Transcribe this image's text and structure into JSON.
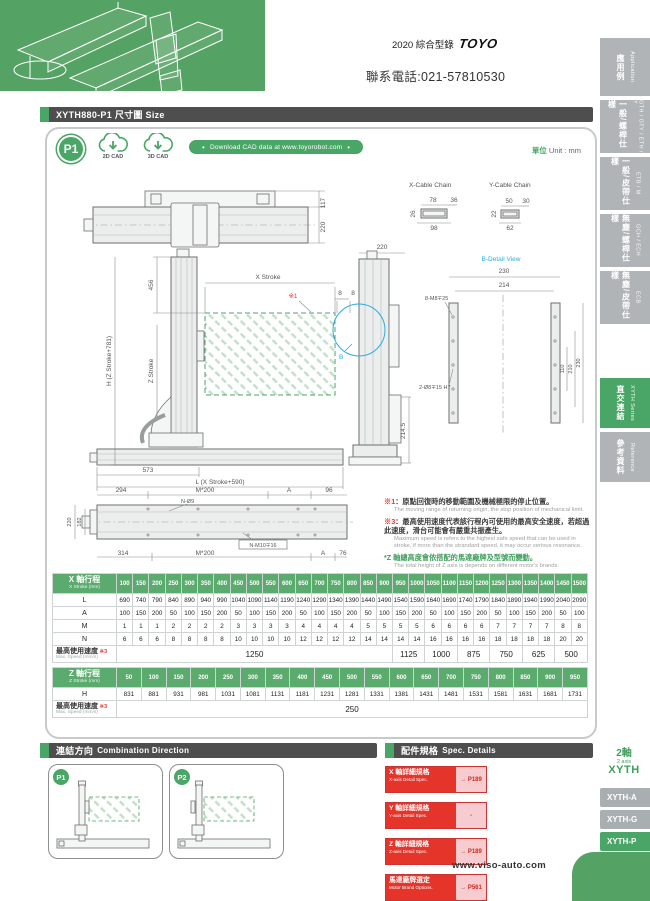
{
  "header": {
    "catalog": "2020 綜合型錄",
    "brand": "TOYO",
    "phone": "聯系電話:021-57810530"
  },
  "title_bar": "XYTH880-P1 尺寸圖 Size",
  "panel": {
    "badge": "P1",
    "cad2d": "2D CAD",
    "cad3d": "3D CAD",
    "download": "Download CAD data at www.toyorobot.com",
    "unit_zh": "單位",
    "unit_en": "Unit : mm"
  },
  "drawings": {
    "top_view": {
      "dim_117": "117",
      "dim_220": "220"
    },
    "cable": {
      "x_title": "X-Cable Chain",
      "x_top": "78",
      "x_right": "36",
      "x_left": "26",
      "x_bottom": "98",
      "y_title": "Y-Cable Chain",
      "y_top": "50",
      "y_right": "30",
      "y_left": "22",
      "y_bottom": "62"
    },
    "front": {
      "dim_456": "456",
      "dim_h": "H (Z Stroke+781)",
      "dim_z": "Z Stroke",
      "dim_x": "X Stroke",
      "ref1": "※1",
      "dim_8a": "8",
      "dim_8b": "8",
      "dim_573": "573",
      "dim_l": "L (X Stroke+590)"
    },
    "side": {
      "dim_220": "220",
      "dim_2145": "214.5",
      "b_label": "B"
    },
    "bdetail": {
      "title": "B-Detail View",
      "dim_230t": "230",
      "dim_214": "214",
      "holes_a": "8-M8∓25",
      "holes_b": "2-Ø8∓15 H7",
      "dim_110": "110",
      "dim_210": "210",
      "dim_230r": "230"
    },
    "bottom": {
      "dim_294": "294",
      "dim_m200t": "M*200",
      "dim_at": "A",
      "dim_96": "96",
      "holes_top": "N-Ø9",
      "dim_220": "220",
      "dim_182": "182",
      "dim_314": "314",
      "dim_m200b": "M*200",
      "holes_bottom": "N-M10∓16",
      "dim_ab": "A",
      "dim_76": "76"
    }
  },
  "notes": {
    "n1_ref": "※1",
    "n1_zh": "：原點回復時的移動範圍及機械極限的停止位置。",
    "n1_en": "The moving range of returning origin, the stop position of mechanical limit.",
    "n3_ref": "※3",
    "n3_zh": "：最高使用速度代表該行程內可使用的最高安全速度，若超過此速度，滑台可能會有嚴重共振產生。",
    "n3_en": "Maximum speed is refers to the highest safe speed that can be used in stroke, if more than the strandard speed, it may occur serious resonance.",
    "nz_zh": "*Z 軸總高度會依搭配的馬達廠牌及型號而變動。",
    "nz_en": "The total height of Z axis is depends on different motor's brands."
  },
  "x_table": {
    "header_zh": "X 軸行程",
    "header_en": "X Stroke (mm)",
    "strokes": [
      100,
      150,
      200,
      250,
      300,
      350,
      400,
      450,
      500,
      550,
      600,
      650,
      700,
      750,
      800,
      850,
      900,
      950,
      1000,
      1050,
      1100,
      1150,
      1200,
      1250,
      1300,
      1350,
      1400,
      1450,
      1500
    ],
    "rows": [
      {
        "label": "L",
        "values": [
          690,
          740,
          790,
          840,
          890,
          940,
          990,
          1040,
          1090,
          1140,
          1190,
          1240,
          1290,
          1340,
          1390,
          1440,
          1490,
          1540,
          1590,
          1640,
          1690,
          1740,
          1790,
          1840,
          1890,
          1940,
          1990,
          2040,
          2090
        ]
      },
      {
        "label": "A",
        "values": [
          100,
          150,
          200,
          50,
          100,
          150,
          200,
          50,
          100,
          150,
          200,
          50,
          100,
          150,
          200,
          50,
          100,
          150,
          200,
          50,
          100,
          150,
          200,
          50,
          100,
          150,
          200,
          50,
          100
        ]
      },
      {
        "label": "M",
        "values": [
          1,
          1,
          1,
          2,
          2,
          2,
          2,
          3,
          3,
          3,
          3,
          4,
          4,
          4,
          4,
          5,
          5,
          5,
          5,
          6,
          6,
          6,
          6,
          7,
          7,
          7,
          7,
          8,
          8
        ]
      },
      {
        "label": "N",
        "values": [
          6,
          6,
          6,
          8,
          8,
          8,
          8,
          10,
          10,
          10,
          10,
          12,
          12,
          12,
          12,
          14,
          14,
          14,
          14,
          16,
          16,
          16,
          16,
          18,
          18,
          18,
          18,
          20,
          20
        ]
      }
    ],
    "speed_label_zh": "最高使用速度",
    "speed_note": "※3",
    "speed_label_en": "Max. Speed (mm/s)",
    "speeds": [
      {
        "value": "1250",
        "span": 17
      },
      {
        "value": "1125",
        "span": 2
      },
      {
        "value": "1000",
        "span": 2
      },
      {
        "value": "875",
        "span": 2
      },
      {
        "value": "750",
        "span": 2
      },
      {
        "value": "625",
        "span": 2
      },
      {
        "value": "500",
        "span": 2
      }
    ]
  },
  "z_table": {
    "header_zh": "Z 軸行程",
    "header_en": "Z Stroke (mm)",
    "strokes": [
      50,
      100,
      150,
      200,
      250,
      300,
      350,
      400,
      450,
      500,
      550,
      600,
      650,
      700,
      750,
      800,
      850,
      900,
      950
    ],
    "rows": [
      {
        "label": "H",
        "values": [
          831,
          881,
          931,
          981,
          1031,
          1081,
          1131,
          1181,
          1231,
          1281,
          1331,
          1381,
          1431,
          1481,
          1531,
          1581,
          1631,
          1681,
          1731
        ]
      }
    ],
    "speed_label_zh": "最高使用速度",
    "speed_note": "※3",
    "speed_label_en": "Max. Speed (mm/s)",
    "speeds": [
      {
        "value": "250",
        "span": 19
      }
    ]
  },
  "combination": {
    "title_zh": "連結方向",
    "title_en": "Combination Direction",
    "items": [
      "P1",
      "P2"
    ]
  },
  "spec_details": {
    "title_zh": "配件規格",
    "title_en": "Spec. Details",
    "buttons": [
      {
        "zh": "X 軸詳細規格",
        "en": "X-axis Detail Spec.",
        "page": "→ P189"
      },
      {
        "zh": "Y 軸詳細規格",
        "en": "Y-axis Detail Spec.",
        "page": "-"
      },
      {
        "zh": "Z 軸詳細規格",
        "en": "Z-axis Detail Spec.",
        "page": "→ P189"
      },
      {
        "zh": "馬達廠牌選定",
        "en": "Motor Brand Options.",
        "page": "→ P561"
      }
    ]
  },
  "series_nav": {
    "axis_zh": "2軸",
    "axis_en": "2 axis",
    "family": "XYTH",
    "tabs": [
      {
        "label": "XYTH-A",
        "active": false
      },
      {
        "label": "XYTH-G",
        "active": false
      },
      {
        "label": "XYTH-P",
        "active": true
      },
      {
        "label": "XYTH-F",
        "active": false
      }
    ]
  },
  "sidebar": {
    "tabs": [
      {
        "zh": "應用例",
        "en": "Application",
        "active": false
      },
      {
        "zh": "一般/螺桿仕樣",
        "en": "GTH / GTY / ETH / Y",
        "active": false
      },
      {
        "zh": "一般/皮帶仕樣",
        "en": "ETB / M",
        "active": false
      },
      {
        "zh": "無塵/螺桿仕樣",
        "en": "GCH / ECH",
        "active": false
      },
      {
        "zh": "無塵/皮帶仕樣",
        "en": "ECB",
        "active": false
      },
      {
        "zh": "直交連結",
        "en": "XYTH Series",
        "active": true
      },
      {
        "zh": "參考資料",
        "en": "Reference",
        "active": false
      }
    ]
  },
  "footer": {
    "website": "www.viso-auto.com"
  }
}
